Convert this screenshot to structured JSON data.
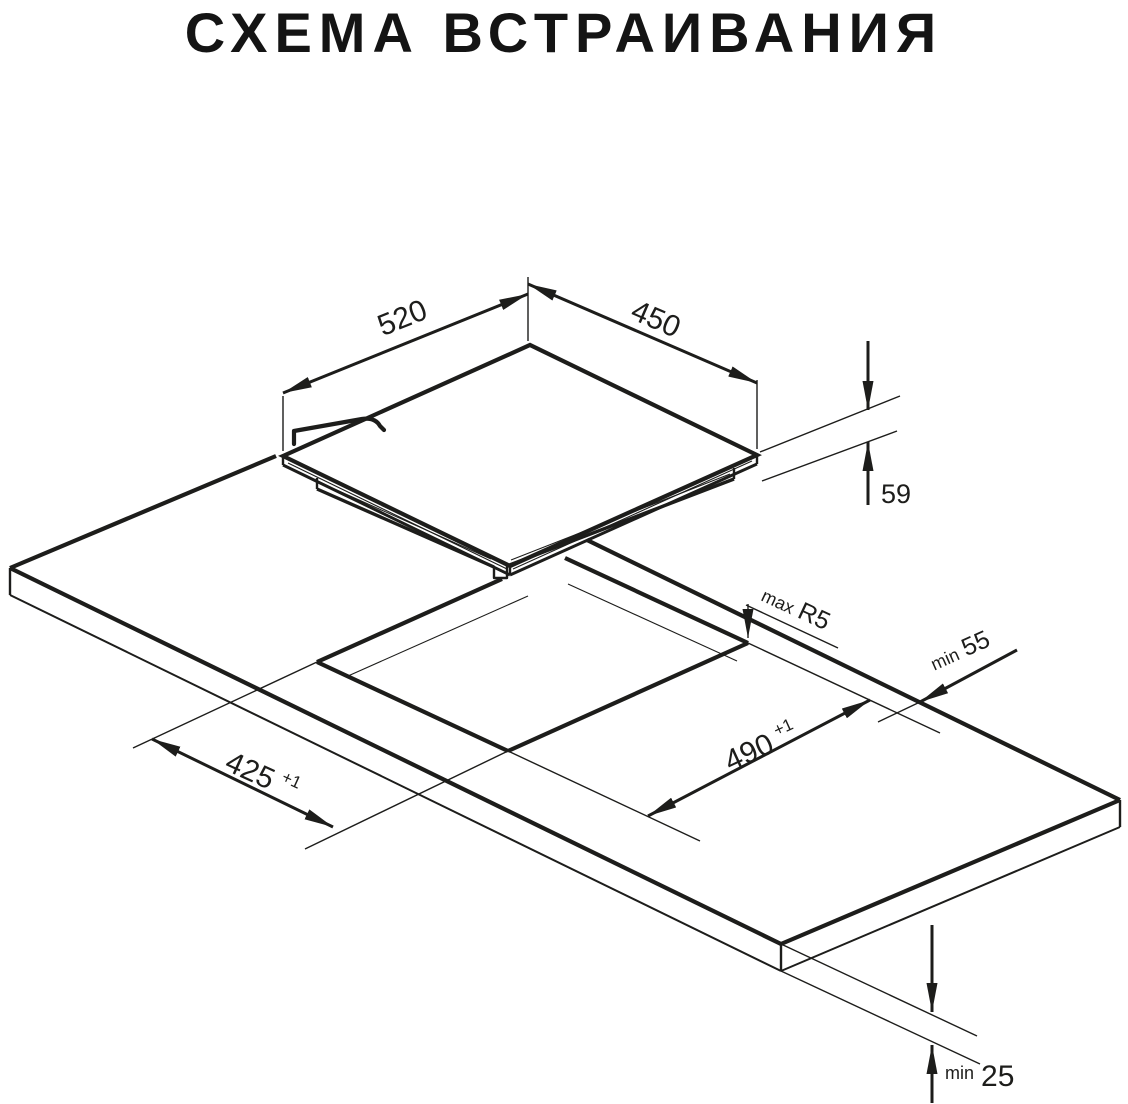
{
  "title": "СХЕМА ВСТРАИВАНИЯ",
  "colors": {
    "line": "#1d1d1b",
    "background": "#ffffff"
  },
  "diagram": {
    "type": "isometric installation drawing of built-in hob and worktop cutout",
    "dimensions": {
      "hob_width": {
        "value": "520"
      },
      "hob_depth": {
        "value": "450"
      },
      "hob_height": {
        "value": "59"
      },
      "corner_radius": {
        "prefix": "max",
        "value": "R5"
      },
      "rear_clearance": {
        "prefix": "min",
        "value": "55"
      },
      "cutout_width": {
        "value": "490",
        "tolerance": "+1"
      },
      "cutout_depth": {
        "value": "425",
        "tolerance": "+1"
      },
      "worktop_thickness": {
        "prefix": "min",
        "value": "25"
      }
    }
  }
}
